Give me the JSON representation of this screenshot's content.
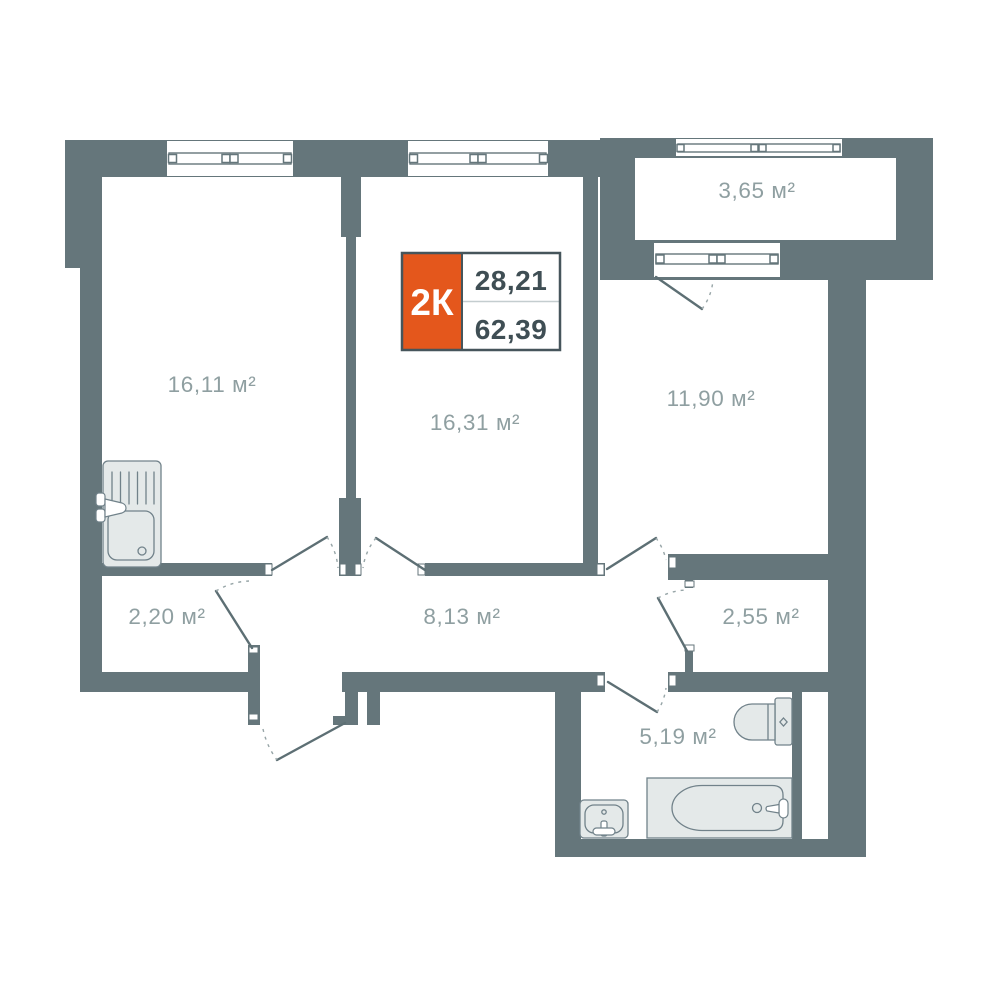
{
  "colors": {
    "wall": "#65767b",
    "accent": "#e4571c",
    "label": "#8f9fa1",
    "card_border": "#46555b",
    "card_text": "#3f4e54"
  },
  "info_card": {
    "unit_type": "2К",
    "living_area": "28,21",
    "total_area": "62,39"
  },
  "rooms": [
    {
      "id": "room-1",
      "area": "16,11 м²"
    },
    {
      "id": "room-2",
      "area": "16,31 м²"
    },
    {
      "id": "room-3",
      "area": "11,90 м²"
    },
    {
      "id": "balcony",
      "area": "3,65 м²"
    },
    {
      "id": "wardrobe",
      "area": "2,20 м²"
    },
    {
      "id": "hallway",
      "area": "8,13 м²"
    },
    {
      "id": "storage",
      "area": "2,55 м²"
    },
    {
      "id": "bathroom",
      "area": "5,19 м²"
    }
  ]
}
